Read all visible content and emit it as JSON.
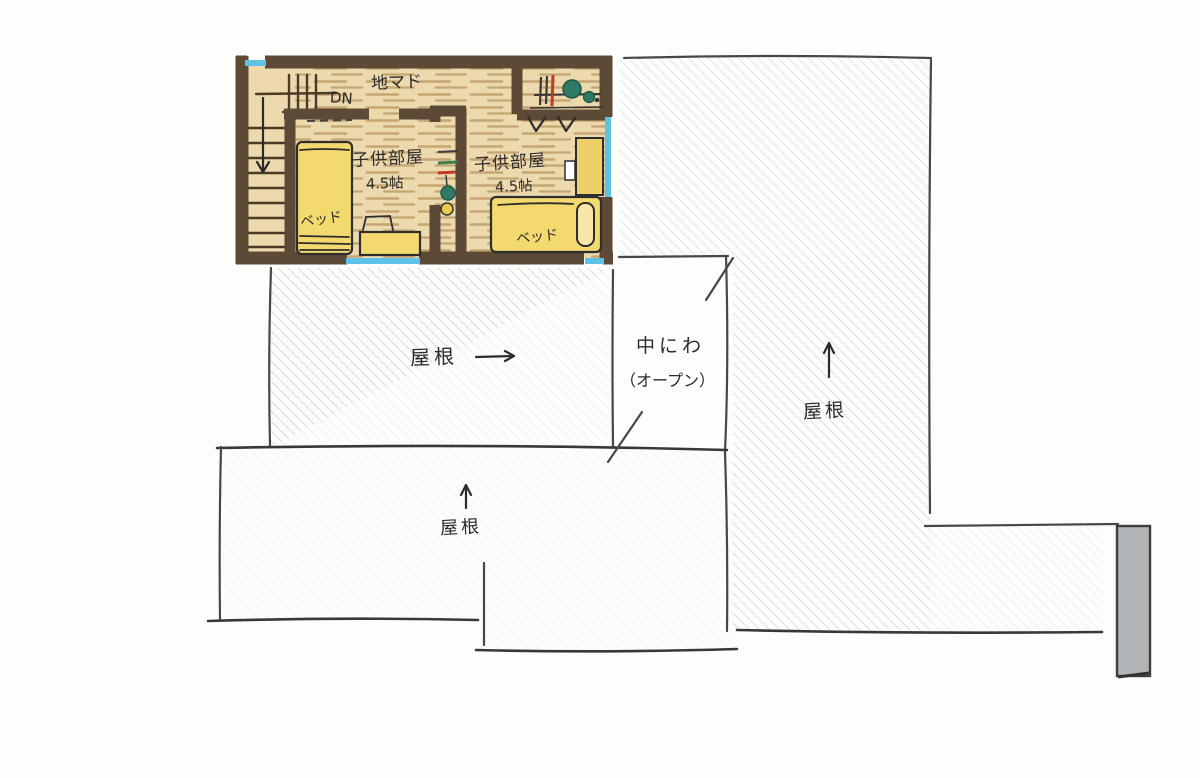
{
  "plan": {
    "labels": {
      "floor_window": "地マド",
      "stairs_down": "DN"
    },
    "rooms": [
      {
        "name": "子供部屋",
        "area": "4.5帖",
        "bed": "ベッド"
      },
      {
        "name": "子供部屋",
        "area": "4.5帖",
        "bed": "ベッド"
      }
    ]
  },
  "annotations": {
    "roof_mid": "屋根",
    "roof_right": "屋根",
    "roof_bottom": "屋根",
    "courtyard": "中にわ",
    "courtyard_note": "（オープン）"
  },
  "colors": {
    "wall_brown": "#5d4a36",
    "floor_base": "#ecd9ae",
    "floor_stroke": "#b28b52",
    "furniture_yellow": "#f3d96e",
    "window_blue": "#5ec1e8",
    "pencil_gray": "#474747",
    "hatch_gray": "#bcc2c9",
    "chimney_gray": "#b2b5b7",
    "accent_teal": "#2e7a66",
    "accent_red": "#c0392b",
    "accent_green": "#3f7d4f"
  }
}
